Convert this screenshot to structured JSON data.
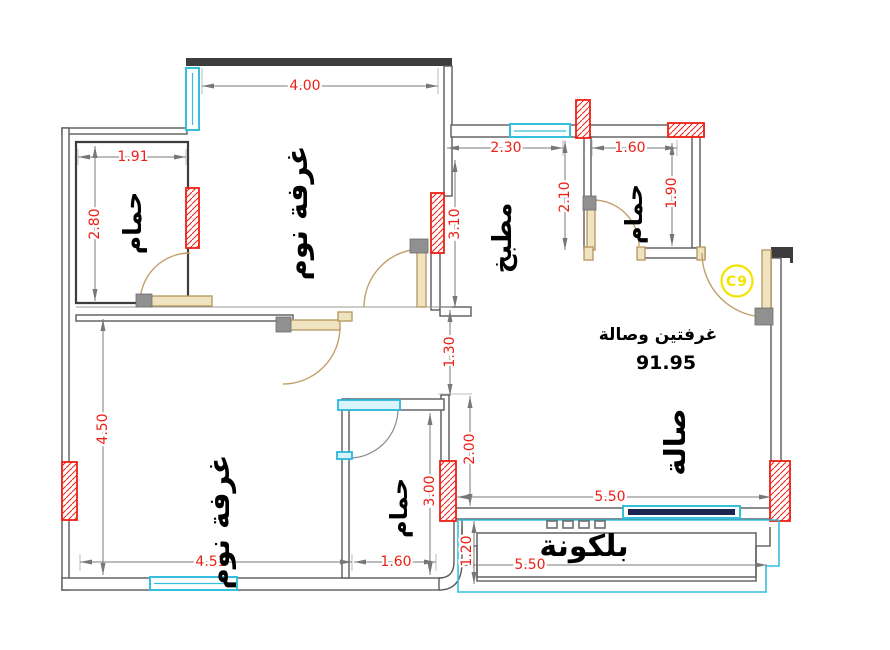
{
  "annotations": {
    "type_label": "غرفتين وصالة",
    "area_value": "91.95",
    "unit_badge": "C9"
  },
  "rooms": {
    "bathroom_top_left": "حمام",
    "bedroom_top": "غرفة نوم",
    "kitchen": "مطبخ",
    "bathroom_top_right": "حمام",
    "hall": "صالة",
    "bedroom_bottom": "غرفة نوم",
    "bathroom_bottom": "حمام",
    "balcony": "بلكونة"
  },
  "dimensions": {
    "bedroom_top_width": "4.00",
    "bath_tl_width": "1.91",
    "bath_tl_depth": "2.80",
    "kitchen_width": "2.30",
    "kitchen_depth": "2.10",
    "kitchen_flank": "3.10",
    "bath_tr_width": "1.60",
    "bath_tr_depth": "1.90",
    "corridor_width": "1.30",
    "hall_flank": "2.00",
    "bath_b_depth": "3.00",
    "bath_b_width": "1.60",
    "bedroom_b_width": "4.51",
    "bedroom_b_depth": "4.50",
    "hall_width": "5.50",
    "balcony_width": "5.50",
    "balcony_depth": "1.20"
  },
  "colors": {
    "dimension_text": "#ed2015",
    "column_accent": "#ed2015",
    "window_frame": "#35bfdf",
    "door_wood": "#c2a06b",
    "wall_stroke": "#5a5a5a",
    "unit_badge": "#f5e400",
    "room_label": "#000000"
  }
}
